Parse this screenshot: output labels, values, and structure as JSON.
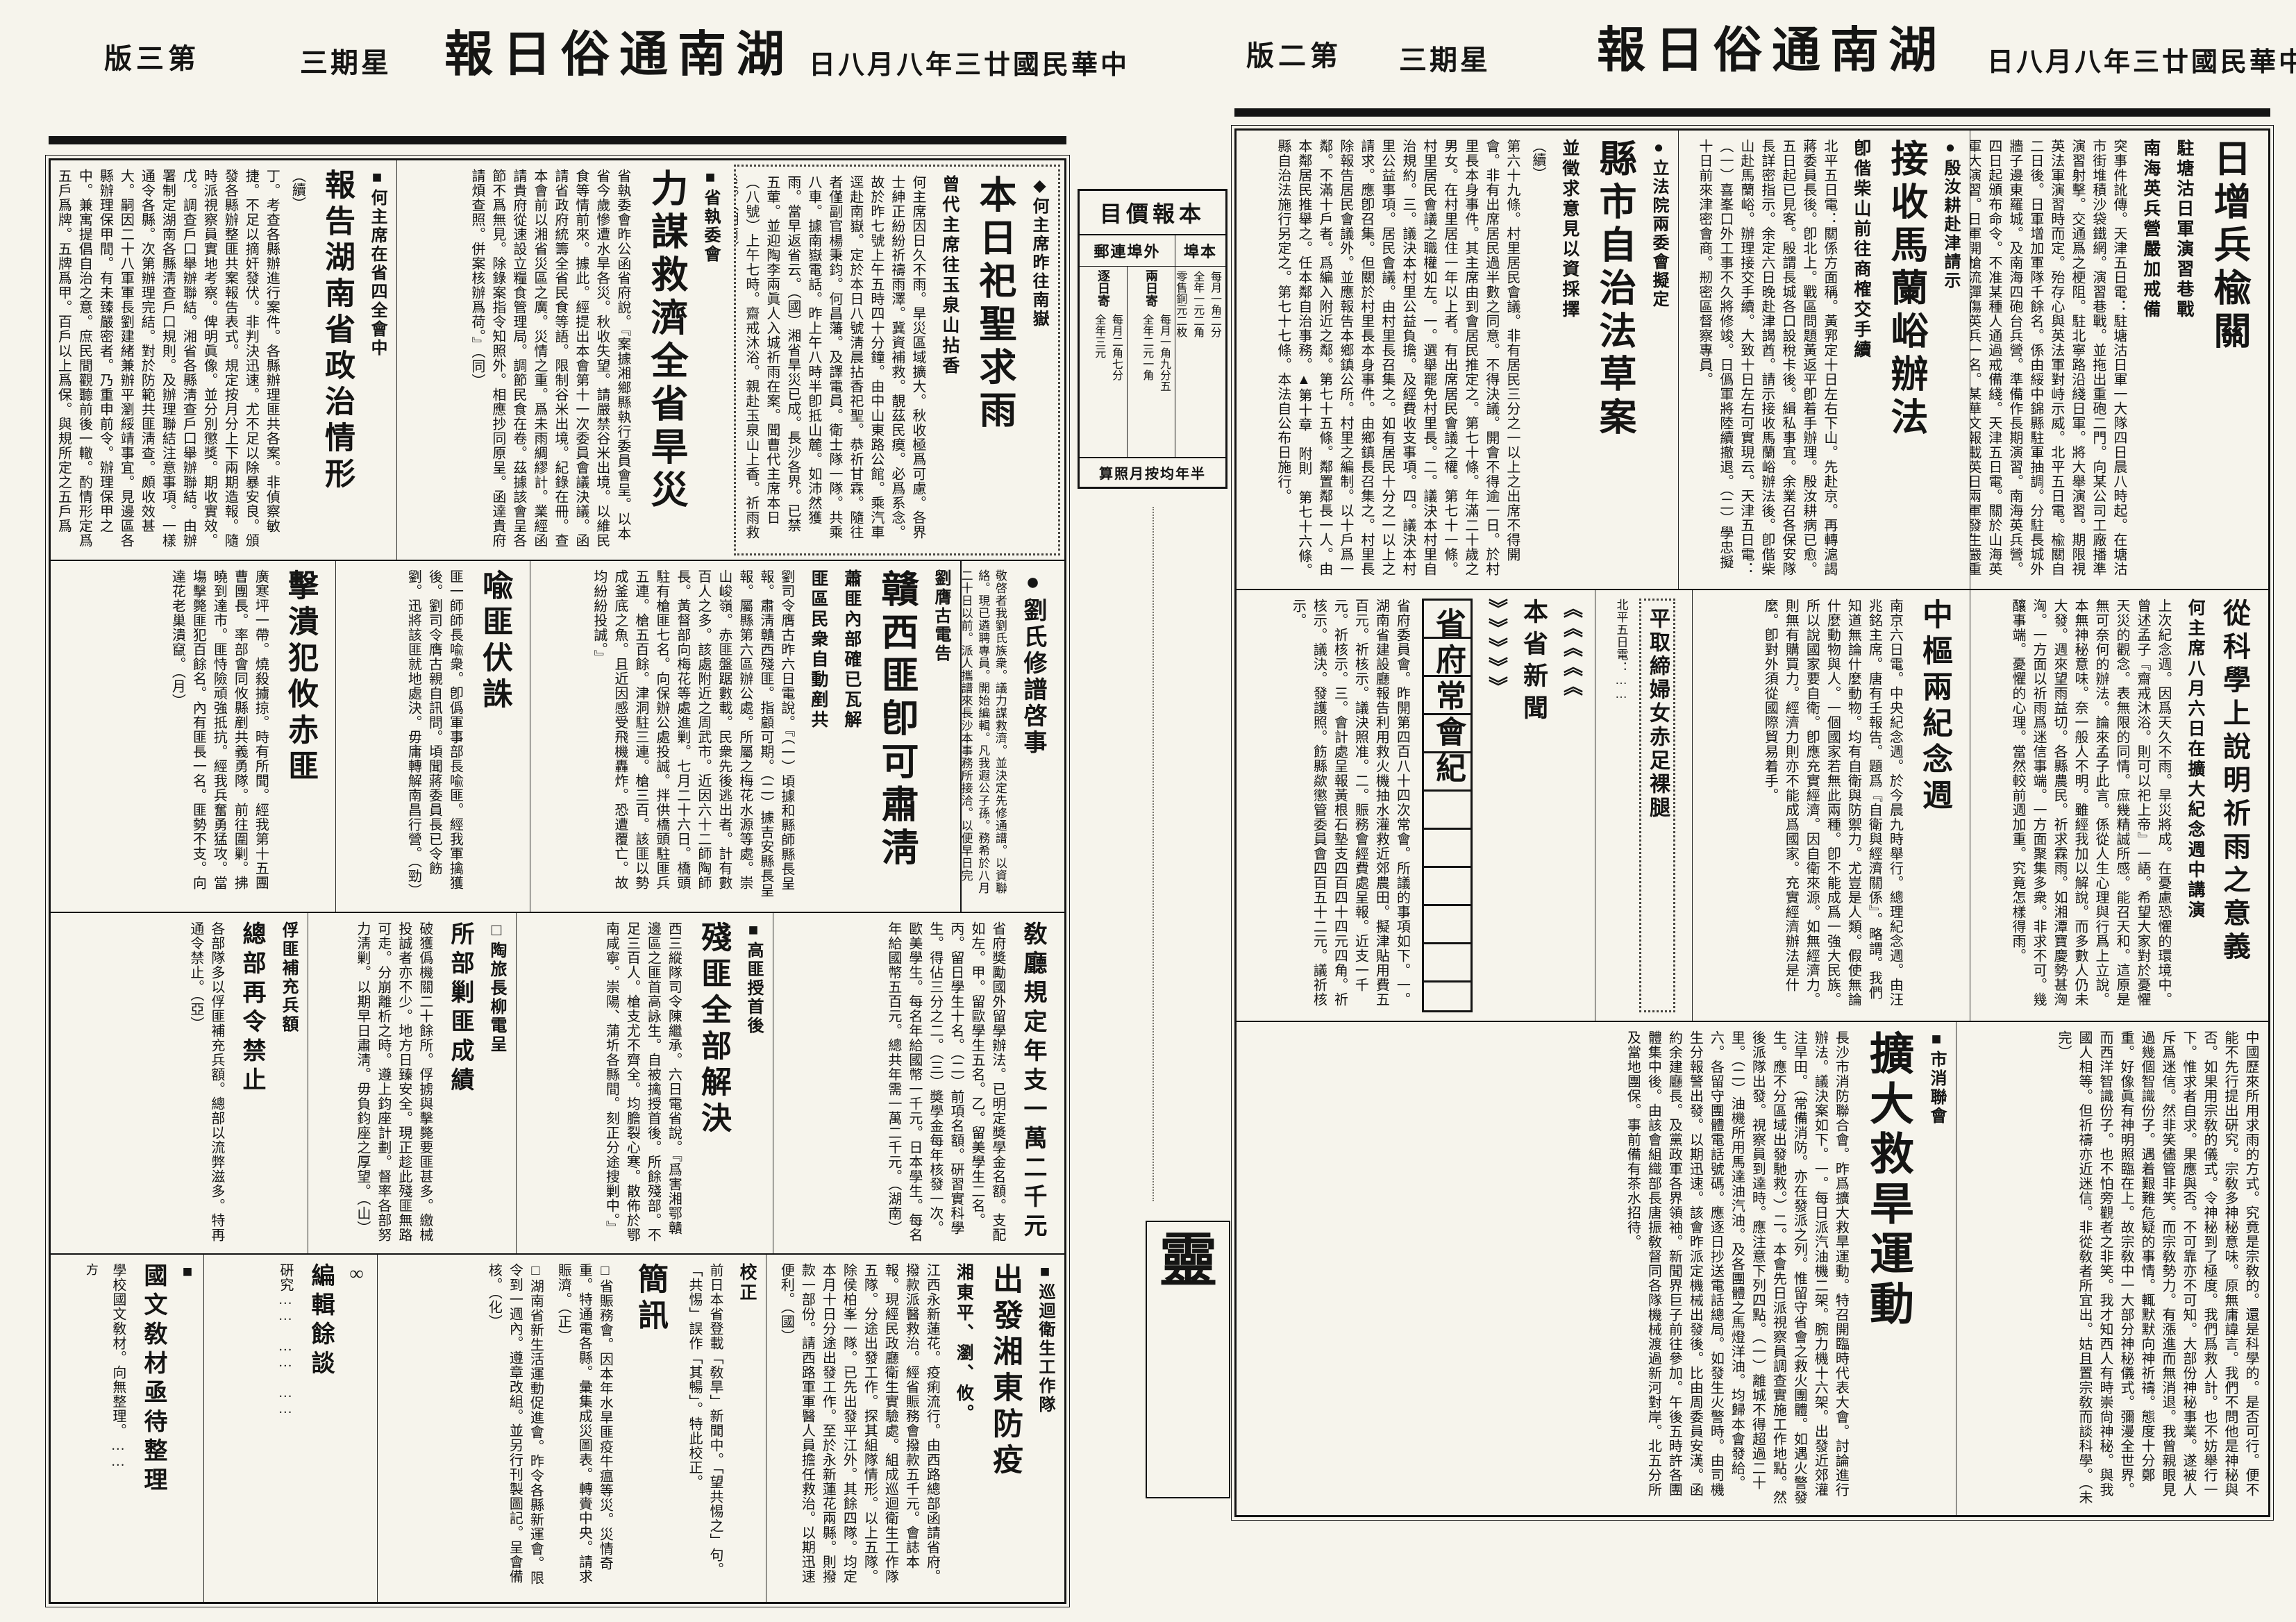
{
  "paper": {
    "title_display": "報日俗通南湖",
    "date_display": "日八月八年三廿國民華中",
    "weekday_display": "三期星"
  },
  "page2": {
    "pageno_display": "版二第",
    "articles": {
      "jp": {
        "headline": "日增兵楡關",
        "sub1": "駐塘沽日軍演習巷戰",
        "sub2": "南海英兵營嚴加戒備",
        "body": "突事件訛傳。天津五日電：駐塘沽日軍一大隊四日晨八時起。在塘沽市街堆積沙袋鐵網。演習巷戰。並拖出重砲二門。向某公司工廠播準演習射擊。交通爲之梗阻。駐北寧路沿綫日軍。將大舉演習。期限視英法軍演習時而定。殆存心與英法軍對峙示威。北平五日電。楡關自二日後。日軍增加軍隊千餘名。係由綏中錦縣駐軍抽調。分駐長城外牆子邊東羅城。及南海四砲台兵營。準備作長期演習。南海英兵營。四日起頒布命令。不准某種人通過戒備綫。天津五日電。關於山海英軍大演習。日軍開槍流彈傷英兵一名。某華文報載英日兩軍發生嚴重衝突之消息。今日經向各方探詢。證不確。仍係日前英日水兵在秦皇島衝突事件之訛傳。此間英日軍事當局均否認此說。"
      },
      "yin": {
        "kicker": "●殷汝耕赴津請示",
        "headline": "接收馬蘭峪辦法",
        "sub1": "卽偕柴山前往商榷交手續",
        "body": "北平五日電：關係方面稱。黃郛定十日左右下山。先赴京。再轉滬謁蔣委員長後。卽北上。戰區問題黃返平卽着手辦理。殷汝耕病已愈。五日起已見客。殷謂長城各口設稅卡後。緝私事宜。余業召各保安隊長詳密指示。余定六日晚赴津謁酋。請示接收馬蘭峪辦法後。卽偕柴山赴馬蘭峪。辦理接交手續。大致十日左右可實現云。天津五日電：（一）喜峯口外工事不久將修竣。日僞軍將陸續撤退。（二）學忠擬十日前來津密會商。剏密區督察專員。"
      },
      "law": {
        "kicker": "●立法院兩委會擬定",
        "headline": "縣市自治法草案",
        "sub1": "並徵求意見以資採擇",
        "cont": "（續）",
        "body": "第六十九條。村里居民會議。非有居民三分之一以上之出席不得開會。非有出席居民過半數之同意。不得決議。開會不得逾一日。於村里長本身事件。其主席由到會居民推定之。第七十條。年滿二十歲之男女。在村里居住一年以上者。有出席居民會議之權。第七十一條。村里居民會議之職權如左。一。選舉罷免村里長。二。議決本村里自治規約。三。議決本村里公益負擔。及經費收支事項。四。議決本村里公益事項。居民會議。由村里長召集之。如有居民十分之一以上之請求。應卽召集。但關於村里長本身事件。由鄉鎮長召集之。村里長除報告居民會議外。並應報告本鄉鎮公所。村里之編制。以十戶爲一鄰。不滿十戶者。爲編入附近之鄰。第七十五條。鄰置鄰長一人。由本鄰居民推舉之。任本鄰自治事務。▲第十章　附則　第七十六條。縣自治法施行另定之。第七十七條。本法自公布日施行。"
      },
      "memorial": {
        "headline": "中樞兩紀念週",
        "body": "南京六日電。中央紀念週。於今晨九時舉行。總理紀念週。由汪兆銘主席。唐有壬報告。題爲『自衛與經濟關係』。略謂。我們知道無論什麼動物。均有自衛與防禦力。尤豈是人類。假使無論什麼動物與人。一個國家若無此兩種。卽不能成爲一強大民族。所以說國家要自衛。卽應充實經濟。因自衛來源。如無經濟力。則無有購買力。經濟力則亦不能成爲國家。充實經濟辦法是什麼。卽對外須從國際貿易着手。"
      },
      "barelegs": {
        "headline": "平取締婦女赤足裸腿",
        "body": "北平五日電：……"
      },
      "rainprayer": {
        "headline": "從科學上說明祈雨之意義",
        "sub1": "何主席八月六日在擴大紀念週中講演",
        "body": "上次紀念週。因爲天久不雨。旱災將成。在憂慮恐懼的環境中。曾述孟子『齋戒沐浴。則可以祀上帝』一語。希望大家對於憂懼天災的觀念。表無限的同情。庶幾精誠所感。能召天和。這原是無可奈何的辦法。論來孟子此言。係從人生心理與行爲上立說。本無神秘意味。奈一般人不明。雖經我加以解說。而多數人仍未大發。週來望雨益切。各縣農民。祈求霖雨。如湘潭寶慶勢甚洶洶。一方面以祈雨爲迷信事端。一方面聚集多衆。非求不可。幾釀事端。憂懼的心理。當然較前週加重。究竟怎樣得雨。"
      },
      "provcouncil": {
        "orn_left": "︾︾︾︾︾",
        "orn_right": "︽︽︽︽︽",
        "orn_title": "本省新聞",
        "headline": "省府常會紀",
        "body": "省府委員會。昨開第四百八十四次常會。所議的事項如下。一。湖南省建設廳報告利用救火機抽水灌救近郊農田。擬津貼用費五百元。祈核示。議決照准。二。賑務會經費處呈報。近支一千元。祈核示。三。會計處呈報黃根石墊支四百四十四元四角。祈核示。議決。發護照。飭縣歘懲管委員會四百五十二元。議祈核示。"
      },
      "rain2": {
        "body": "中國歷來所用求雨的方式。究竟是宗敎的。還是科學的。是否可行。便不能不先行提出硏究。宗敎多神秘意味。原無庸諱言。我們不問他是神秘與否。如果用宗敎的儀式。令神秘到了極度。我們爲救人計。也不妨舉行一下。惟求者自求。果應與否。不可靠亦不可知。大部份神秘事業。遂被人斥爲迷信。然非笑儘管非笑。而宗敎勢力。有漲進而無消退。我曾親眼見過幾個智識份子。遇着艱難危疑的事情。輒默默向神祈禱。態度十分鄭重。好像眞有神明照臨在上。故宗敎中一大部分神秘儀式。彌漫全世界。而西洋智識份子。也不怕旁觀者之非笑。我才知西人有時崇尙神秘。與我國人相等。但祈禱亦近迷信。非從敎者所宜出。姑且置宗敎而談科學。（未完）"
      },
      "drought": {
        "kicker": "■市消聯會",
        "headline": "擴大救旱運動",
        "body": "長沙市消防聯合會。昨爲擴大救旱運動。特召開臨時代表大會。討論進行辦法。議決案如下。一。每日派汽油機二架。腕力機十六架。出發近郊灌注旱田。（常備消防。亦在發派之列。惟留守省會之救火團體。如遇火警發生。應不分區域出發馳救。）二。本會先日派視察員調查實施工作地點。然後派隊出發。視察員到達時。應注意下列四點。（一）離城不得超過二十里。（二）油機所用馬達油汽油。及各團體之馬燈洋油。均歸本會發給。六。各留守團體電話號碼。應逐日抄送電話總局。如發生火警時。由司機生分報警出發。以期迅速。該會昨派定機械出發後。比由周委員安漢。函約余建廳長。及黨政軍各界領袖。新聞界巨子前往參加。午後五時許各團體集中後。由該會組織部長唐振敎督同各隊機械渡過新河對岸。北五分所及當地團保。事前備有茶水招待。"
      }
    }
  },
  "page3": {
    "pageno_display": "版三第",
    "articles": {
      "sacrifice": {
        "kicker": "◆何主席昨往南嶽",
        "headline": "本日祀聖求雨",
        "sub1": "曾代主席往玉泉山拈香",
        "body": "何主席因日久不雨。旱災區域擴大。秋收極爲可慮。各界士紳正紛紛祈禱雨澤。冀資補救。靚茲民瘼。必爲系念。故於昨七號上午五時四十分鐘。由中山東路公館。乘汽車逕赴南嶽。定於本日八號淸晨拈香祀聖。恭祈甘霖。隨往者僅副官楊秉鈞。何昌藩。及譯電員。衛士隊一隊。共乘八車。據南嶽電話。昨上午八時半卽抵山麓。如沛然獲雨。當早返省云。（國）湘省旱災已成。長沙各界。已禁五葷。並迎陶李兩眞人入城祈雨在案。聞曹代主席本日（八號）上午七時。齋戒沐浴。親赴玉泉山上香。祈雨救災。（湖南）"
      },
      "relief": {
        "kicker": "■省執委會",
        "headline": "力謀救濟全省旱災",
        "body": "省執委會昨公函省府說。『案據湘鄉縣執行委員會呈。以本省今歲慘遭水旱各災。秋收失望。請嚴禁谷米出境。以維民食等情前來。據此。經提出本會第十一次委員會議決議。函請省政府統籌全省民食等語。限制谷米出境。紀錄在冊。查本會前以湘省災區之廣。災情之重。爲未雨綢繆計。業經函請貴府從速設立糧食管理局。調節民食在卷。茲據該會呈各節不爲無見。除錄案指令知照外。相應抄同原呈。函達貴府請煩查照。併案核辦爲荷。』（同）"
      },
      "report": {
        "kicker": "■何主席在省四全會中",
        "headline": "報告湖南省政治情形",
        "cont": "（續）",
        "body": "丁。考查各縣辦進行案件。各縣辦理匪共各案。非偵察敏捷。不足以摘奸發伏。非判決迅速。尤不足以除暴安良。頒發各縣辦整匪共案報告表式。規定按月分上下兩期造報。隨時派視察員實地考察。俾明眞像。並分別懲獎。期收實效。戊。調查戶口舉辦聯結。湘省各縣淸查戶口舉辦聯結。由辦署制定湖南各縣淸查戶口規則。及辦理聯結注意事項。一樣通令各縣。次第辦理完結。對於防範共匪淸查。頗收效甚大。嗣因二十八軍軍長劉建緒兼辦平瀏綏靖事宜。見邊區各縣辦理保甲間。有未臻嚴密者。乃重申前令。辦理保甲之中。兼寓提倡自治之意。庶民間觀聽前後一轍。酌情形定爲五戶爲牌。五牌爲甲。百戶以上爲保。與規所定之五戶爲鄰。鄰爲閭。百戶以上爲鄉鎮者。實相吻合。案通令頒行。（未完）"
      },
      "genealogy": {
        "headline": "●劉氏修譜啓事",
        "body": "敬啓者我劉氏族衆。議力謀救濟。並決定先修通譜。以資聯絡。現已遴聘專員。開始編輯。凡我遐公子孫。務希於八月二十日以前。派人攜譜來長沙本事務所接洽。以便早日完成。我族幸甚。劉遐公輯譜事務所啓。●通訊處　長沙富雅里一號"
      },
      "jiangxi": {
        "kicker": "劉膺古電告",
        "headline": "贛西匪卽可肅淸",
        "sub1": "蕭匪內部確已瓦解",
        "sub2": "匪區民衆自動剷共",
        "body": "劉司令膺古昨六日電說。『（一）頃據和縣師縣長呈報。肅淸贛西殘匪。指顧可期。（二）據吉安縣長呈報。屬縣第六區辦公處。所屬之梅花水源等處。崇山峻嶺。赤匪盤踞數載。民衆先後逃出者。計有數百人之多。該處附近之周武市。近因六十二師陶師長。黃督部向梅花等處進剿。七月二十六日。橋頭駐有槍匪七名。向保辦公處投誠。拌供橋頭駐匪兵五連。槍五百餘。津洞駐三連。槍三百。該匪以勢成釜底之魚。且近因感受飛機轟炸。恐遭覆亡。故均紛紛投誠。』"
      },
      "yu": {
        "headline": "喩匪伏誅",
        "body": "匪一師師長喩衆。卽僞軍事部長喩匪。經我軍擒獲後。劉司令膺古親自訊問。頃聞蔣委員長已令飭劉。迅將該匪就地處決。毋庸轉解南昌行營。（勁）"
      },
      "you": {
        "headline": "擊潰犯攸赤匪",
        "body": "廣寒坪一帶。燒殺擄掠。時有所聞。經我第十五團曹團長。率部會同攸縣剷共義勇隊。前往圍剿。拂曉到達市。匪恃險頑強抵抗。經我兵奮勇猛攻。當塲擊斃匪犯百餘名。內有匪長一名。匪勢不支。向達花老巢潰竄。（月）"
      },
      "scholarship": {
        "headline": "敎廳規定年支一萬二千元",
        "body": "省府奬勵國外留學辦法。已明定奬學金名額。支配如左。甲。留歐學生五名。乙。留美學生二名。丙。留日學生十名。（二）前項名額。硏習實科學生。得佔三分之二。（三）奬學金每年核發一次。歐美學生。每名年給國幣一千元。日本學生。每名年給國幣五百元。總共年需一萬二千元。（湖南）"
      },
      "remnants": {
        "kicker": "■高匪授首後",
        "headline": "殘匪全部解決",
        "body": "西三縱隊司令陳繼承。六日電省說。『爲害湘鄂贛邊區之匪首高詠生。自被擒授首後。所餘殘部。不足三百人。槍支尤不齊全。均膽裂心寒。散佈於鄂南咸寧。崇陽、蒲圻各縣間。刻正分途搜剿中。』"
      },
      "suppression": {
        "kicker": "□陶旅長柳電呈",
        "headline": "所部剿匪成績",
        "body": "破獲僞機關二十餘所。俘掳與擊斃要匪甚多。繳械投誠者亦不少。地方日臻安全。現正趁此殘匪無路可走。分崩離析之時。遵上鈞座計劃。督率各部努力淸剿。以期早日肅淸。毋負鈞座之厚望。（山）"
      },
      "ban": {
        "kicker": "俘匪補充兵額",
        "headline": "總部再令禁止",
        "body": "各部隊多以俘匪補充兵額。總部以流弊滋多。特再通令禁止。（亞）"
      },
      "epidemic": {
        "kicker": "■巡迴衛生工作隊",
        "headline": "出發湘東防疫",
        "sub1": "湘東平、瀏、攸。",
        "body": "江西永新蓮花。疫痢流行。由西路總部函請省府。撥款派醫救治。經省賑務會撥款五千元。會誌本報。現經民政廳衛生實驗處。組成巡迴衛生工作隊五隊。分途出發工作。探其組隊情形。以上五隊。除侯柏峯一隊。已先出發平江外。其餘四隊。均定本月十日分途出發工作。至於永新蓮花兩縣。則撥款一部份。請西路軍軍醫人員擔任救治。以期迅速便利。（國）"
      },
      "briefs": {
        "headline": "簡訊",
        "correction_head": "校正",
        "correction": "前日本省登載「敎旱」新聞中。「望共惕之」句。「共惕」誤作「其暢」。特此校正。",
        "item1": "□省賑務會。因本年水旱匪疫牛瘟等災。災情奇重。特通電各縣。彙集成災圖表。轉賫中央。請求賑濟。（正）",
        "item2": "□湖南省新生活運動促進會。昨令各縣新運會。限令到一週內。遵章改組。並另行刊製圖記。呈會備核。（化）"
      },
      "editor": {
        "headline": "編輯餘談",
        "orn": "∞",
        "body": "硏究……　……　……"
      },
      "textbook": {
        "kicker": "■",
        "headline": "國文敎材亟待整理",
        "sig": "方",
        "body": "學校國文敎材。向無整理。……"
      }
    }
  },
  "pricebox": {
    "title_display": "目價報本",
    "local_head_display": "埠本",
    "out_head_display": "郵連埠外",
    "two_day_head": "兩日寄",
    "daily_head": "逐日寄",
    "local_lines": [
      "每月一角二分",
      "全年一元二角",
      "零售銅元二枚"
    ],
    "two_day_lines": [
      "每月一角九分五",
      "全年二元一角"
    ],
    "daily_lines": [
      "每月二角七分",
      "全年三元"
    ],
    "footer_display": "算照月按均年半"
  },
  "lingad": {
    "big": "靈",
    "line1": "熱季",
    "line2": "更誦",
    "small1": "長沙黃南街",
    "small2": "印刷發行"
  }
}
